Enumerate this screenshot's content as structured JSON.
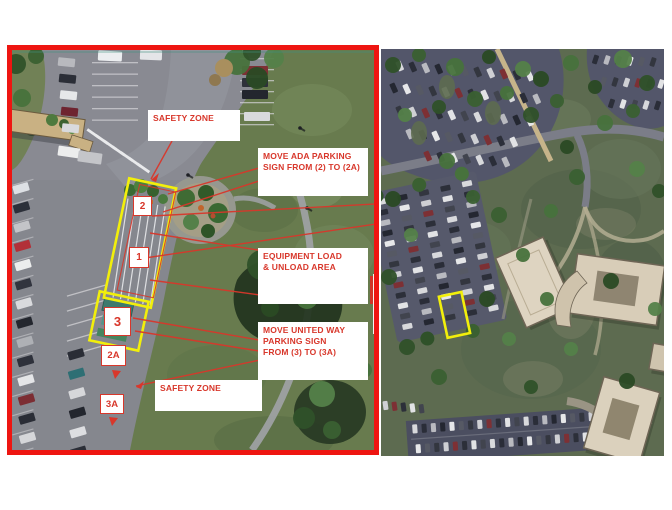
{
  "figure": {
    "type": "annotated aerial site plan, detail view beside campus overview"
  },
  "colors": {
    "annotation_red": "#d8372b",
    "panel_border_red": "#ee1511",
    "highlight_yellow": "#f2ef0b",
    "label_background": "#ffffff"
  },
  "left_panel": {
    "labels": {
      "safety_zone_top": "SAFETY ZONE",
      "move_ada_line1": "MOVE ADA PARKING",
      "move_ada_line2": "SIGN FROM (2) TO (2A)",
      "equipment_line1": "EQUIPMENT LOAD",
      "equipment_line2": "& UNLOAD AREA",
      "united_way_line1": "MOVE UNITED WAY",
      "united_way_line2": "PARKING SIGN",
      "united_way_line3": "FROM (3) TO (3A)",
      "safety_zone_bottom": "SAFETY ZONE"
    },
    "markers": {
      "m1": "1",
      "m2": "2",
      "m3": "3",
      "m2a": "2A",
      "m3a": "3A"
    }
  }
}
